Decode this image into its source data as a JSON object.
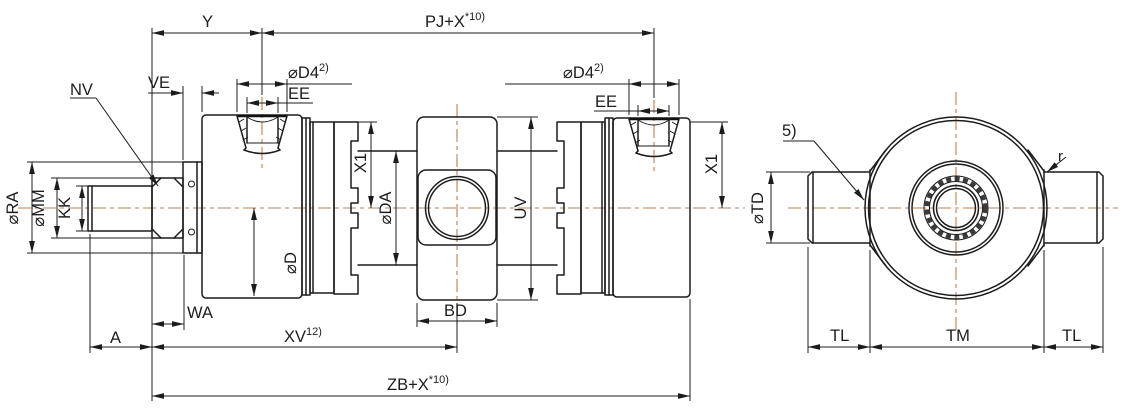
{
  "drawing": {
    "type": "engineering-drawing",
    "subject": "hydraulic cylinder with center trunnion, side section view and end view",
    "colors": {
      "line": "#1c1c1c",
      "centerline": "#bf7f4f",
      "background": "#ffffff"
    },
    "labels": {
      "y": "Y",
      "pj_base": "PJ+X",
      "pj_sup": "*10)",
      "ve": "VE",
      "nv": "NV",
      "d4_base": "⌀D4",
      "d4_sup": "2)",
      "ee": "EE",
      "x1": "X1",
      "da": "⌀DA",
      "uv": "UV",
      "d": "⌀D",
      "ra": "⌀RA",
      "mm": "⌀MM",
      "kk": "KK",
      "wa": "WA",
      "a": "A",
      "xv_base": "XV",
      "xv_sup": "12)",
      "bd": "BD",
      "zb_base": "ZB+X",
      "zb_sup": "*10)",
      "td": "⌀TD",
      "tl": "TL",
      "tm": "TM",
      "r": "r",
      "note5": "5)"
    }
  }
}
